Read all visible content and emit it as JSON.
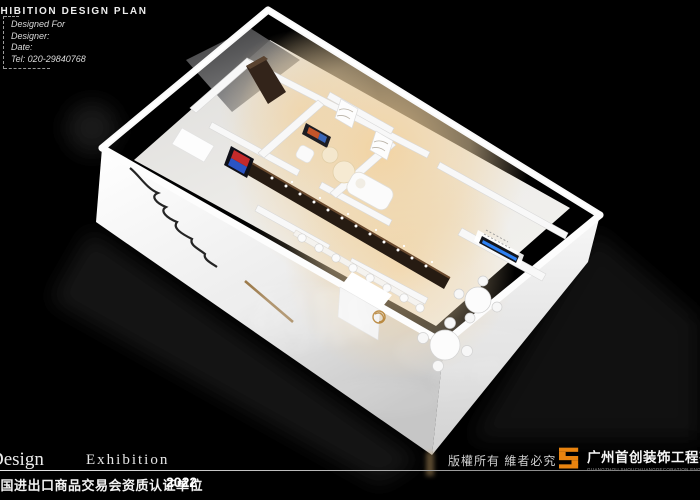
{
  "header": {
    "title": "EXHIBITION DESIGN PLAN",
    "designer_box": {
      "line1": "Designed For",
      "line2": "Designer:",
      "line3": "Date:",
      "line4": "Tel: 020-29840768"
    }
  },
  "footer": {
    "brand_serif_left": "Design",
    "brand_serif_right": "Exhibition",
    "certification": "中国进出口商品交易会资质认证单位",
    "year": "2022",
    "copyright": "版權所有 維者必究",
    "company_cn": "广州首创装饰工程有限公司",
    "company_en": "GUANGZHOU SHOUCHUANGDECORATION ENGINEERING CO., LTD"
  },
  "watermark": {
    "text": "创展"
  },
  "colors": {
    "background": "#000000",
    "accent_orange": "#e8830f",
    "wall_white": "#f4f4f4",
    "warm_floor_glow": "#f0d9b0",
    "display_wall_dark": "#241a12",
    "screen_blue": "#2e86ff",
    "gold_emblem": "#b8863b"
  }
}
